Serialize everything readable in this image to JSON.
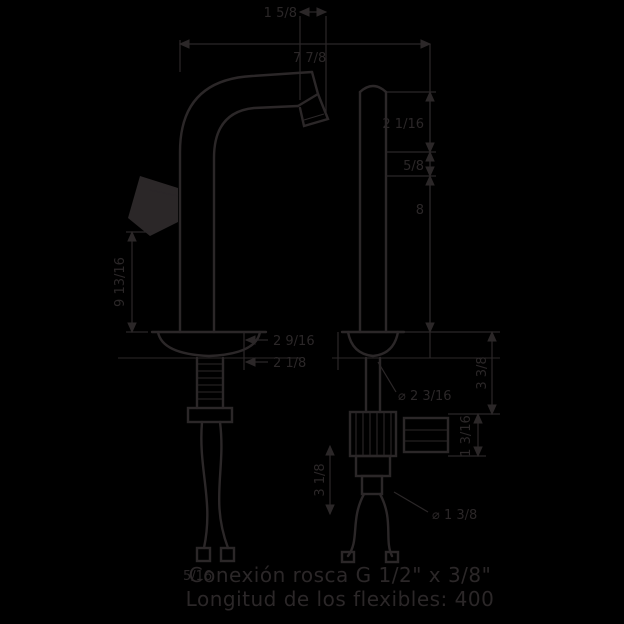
{
  "colors": {
    "background": "#000000",
    "ink": "#2b2728"
  },
  "labels": [
    {
      "id": "dim-spout-tip-width",
      "text": "1 5/8"
    },
    {
      "id": "dim-overall-width",
      "text": "7 7/8"
    },
    {
      "id": "dim-upper-right",
      "text": "2 1/16"
    },
    {
      "id": "dim-spout-drop",
      "text": "5/8"
    },
    {
      "id": "dim-body-height-right",
      "text": "8"
    },
    {
      "id": "dim-height-left",
      "text": "9 13/16"
    },
    {
      "id": "dim-base-a",
      "text": "2 9/16"
    },
    {
      "id": "dim-base-b",
      "text": "2 1/8"
    },
    {
      "id": "dim-flange-diameter",
      "text": "⌀ 2 3/16"
    },
    {
      "id": "dim-right-offset",
      "text": "3 3/8"
    },
    {
      "id": "dim-bracket-height",
      "text": "1 3/16"
    },
    {
      "id": "dim-hose-drop",
      "text": "3 1/8"
    },
    {
      "id": "dim-shank-diameter",
      "text": "⌀ 1 3/8"
    },
    {
      "id": "dim-hose-end",
      "text": "5/16"
    }
  ],
  "notes": {
    "line1": "Conexión rosca G 1/2\" x 3/8\"",
    "line2": "Longitud de los flexibles: 400"
  }
}
